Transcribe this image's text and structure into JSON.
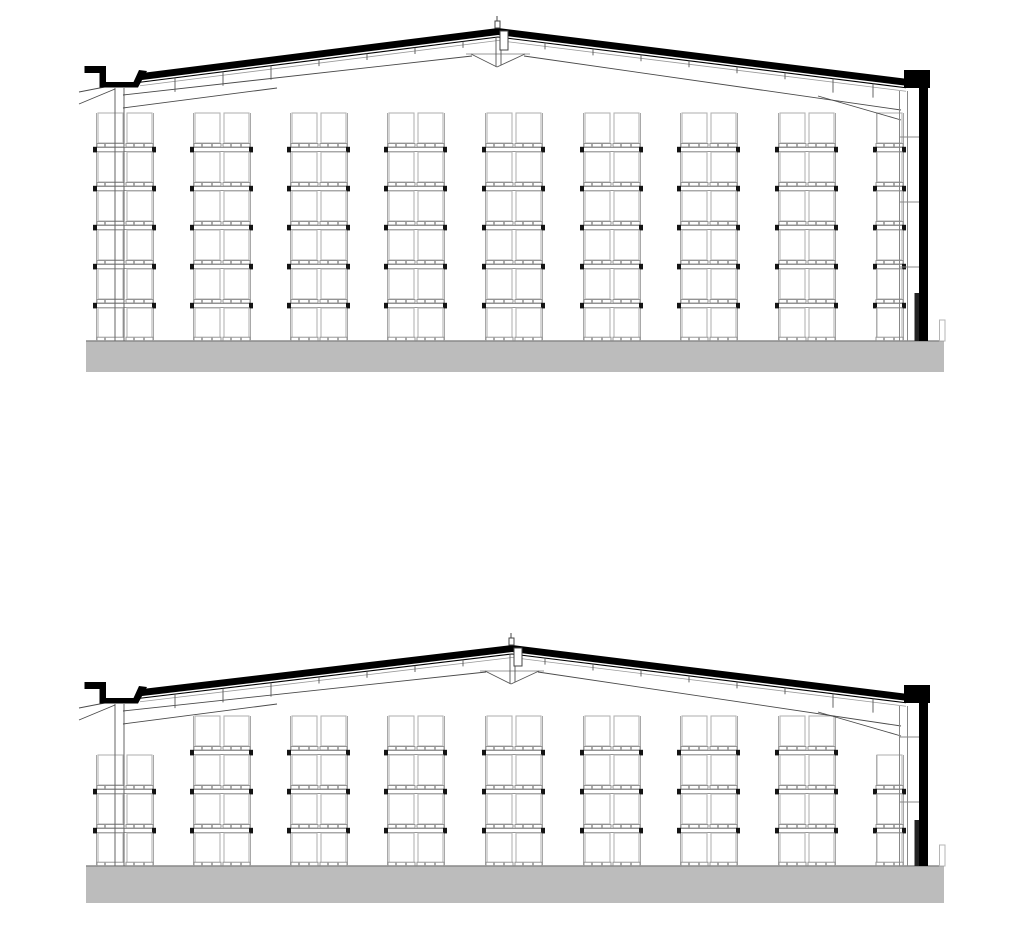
{
  "page": {
    "background": "#ffffff"
  },
  "drawing": {
    "canvas": {
      "width": 1024,
      "height": 950
    },
    "colors": {
      "black": "#000000",
      "line_dark": "#4a4a4a",
      "line_mid": "#8c8c8c",
      "line_light": "#b5b5b5",
      "upright": "#a8a8a8",
      "slab_fill": "#bcbcbc",
      "slab_edge": "#8a8a8a",
      "beam_cap": "#141414",
      "white": "#ffffff"
    },
    "sections": [
      {
        "name": "building-section-upper",
        "ridge": {
          "x": 498,
          "y": 28
        },
        "eave_left": {
          "x": 138,
          "y": 73.5
        },
        "eave_right": {
          "x": 908,
          "y": 79
        },
        "band_thickness": 7,
        "apex": {
          "cap": [
            495,
            21,
            5,
            7
          ],
          "beam": [
            500,
            31,
            8,
            19
          ],
          "bracket_half_width": 27,
          "bracket_top_offset": 26,
          "bracket_tip_offset": 39
        },
        "gutter": {
          "bar": [
            84.5,
            66,
            18,
            7
          ],
          "face": [
            99.5,
            66,
            6.5,
            21
          ],
          "channel": [
            99.5,
            82,
            37,
            5.5
          ],
          "riser": [
            [
              131,
              87.5
            ],
            [
              139,
              70
            ],
            [
              147,
              71
            ],
            [
              138,
              87.5
            ]
          ]
        },
        "parapet": {
          "cap": [
            904,
            70,
            26,
            18
          ],
          "wall": [
            919,
            88,
            9,
            253
          ],
          "strip": [
            914.5,
            293,
            4.5,
            48
          ]
        },
        "left_column": {
          "x": [
            115,
            124
          ],
          "top": 88,
          "bottom": 341
        },
        "right_liner": {
          "x": [
            899.5,
            907.5
          ],
          "top": 91,
          "bottom": 341,
          "girts": [
            137,
            202,
            267
          ],
          "girt_x2": 919
        },
        "cut_lines": [
          [
            79,
            92,
            115,
            85
          ],
          [
            79,
            104,
            115,
            89
          ]
        ],
        "rafter_lines": [
          [
            123,
            95,
            472,
            56
          ],
          [
            524,
            56,
            901,
            110
          ],
          [
            123,
            108,
            277,
            88
          ],
          [
            818,
            96,
            901,
            120
          ]
        ],
        "purlin_ticks": {
          "left": [
            175,
            223,
            271,
            319,
            367,
            415,
            463
          ],
          "right": [
            545,
            593,
            641,
            689,
            737,
            785,
            833,
            873
          ],
          "tall": [
            175,
            223,
            271,
            833,
            873
          ]
        },
        "slab": {
          "rect": [
            86,
            341,
            858,
            31
          ],
          "curb": [
            939.5,
            320,
            5.5,
            21
          ]
        },
        "racks": {
          "box_w": 25,
          "box_h": 30,
          "pitch": 39,
          "double_bays": [
            {
              "x": 96,
              "top": 113,
              "levels": 6
            },
            {
              "x": 193,
              "top": 113,
              "levels": 6
            },
            {
              "x": 290,
              "top": 113,
              "levels": 6
            },
            {
              "x": 387,
              "top": 113,
              "levels": 6
            },
            {
              "x": 485,
              "top": 113,
              "levels": 6
            },
            {
              "x": 583,
              "top": 113,
              "levels": 6
            },
            {
              "x": 680,
              "top": 113,
              "levels": 6
            },
            {
              "x": 778,
              "top": 113,
              "levels": 6
            }
          ],
          "single_bays": [
            {
              "x": 876,
              "top": 113,
              "levels": 6
            }
          ]
        }
      },
      {
        "name": "building-section-lower",
        "ridge": {
          "x": 512,
          "y": 645
        },
        "eave_left": {
          "x": 138,
          "y": 689.5
        },
        "eave_right": {
          "x": 908,
          "y": 694
        },
        "band_thickness": 7,
        "apex": {
          "cap": [
            509,
            638,
            5,
            7
          ],
          "beam": [
            514,
            648,
            8,
            18
          ],
          "bracket_half_width": 27,
          "bracket_top_offset": 26,
          "bracket_tip_offset": 39
        },
        "gutter": {
          "bar": [
            84.5,
            682,
            18,
            7
          ],
          "face": [
            99.5,
            682,
            6.5,
            21
          ],
          "channel": [
            99.5,
            698,
            37,
            5.5
          ],
          "riser": [
            [
              131,
              703.5
            ],
            [
              139,
              686
            ],
            [
              147,
              687
            ],
            [
              138,
              703.5
            ]
          ]
        },
        "parapet": {
          "cap": [
            904,
            685,
            26,
            18
          ],
          "wall": [
            919,
            703,
            9,
            163
          ],
          "strip": [
            914.5,
            820,
            4.5,
            46
          ]
        },
        "left_column": {
          "x": [
            115,
            124
          ],
          "top": 704,
          "bottom": 866
        },
        "right_liner": {
          "x": [
            899.5,
            907.5
          ],
          "top": 706,
          "bottom": 866,
          "girts": [
            737,
            802
          ],
          "girt_x2": 919
        },
        "cut_lines": [
          [
            79,
            708,
            115,
            701
          ],
          [
            79,
            720,
            115,
            705
          ]
        ],
        "rafter_lines": [
          [
            123,
            711,
            486,
            672
          ],
          [
            538,
            672,
            901,
            726
          ],
          [
            123,
            724,
            277,
            704
          ],
          [
            818,
            712,
            901,
            736
          ]
        ],
        "purlin_ticks": {
          "left": [
            175,
            223,
            271,
            319,
            367,
            415,
            463
          ],
          "right": [
            545,
            593,
            641,
            689,
            737,
            785,
            833,
            873
          ],
          "tall": [
            175,
            223,
            271,
            833,
            873
          ]
        },
        "slab": {
          "rect": [
            86,
            866,
            858,
            37
          ],
          "curb": [
            939.5,
            845,
            5.5,
            21
          ]
        },
        "racks": {
          "box_w": 25,
          "box_h": 30,
          "pitch": 39,
          "double_bays": [
            {
              "x": 96,
              "top": 755,
              "levels": 3
            },
            {
              "x": 193,
              "top": 716,
              "levels": 4
            },
            {
              "x": 290,
              "top": 716,
              "levels": 4
            },
            {
              "x": 387,
              "top": 716,
              "levels": 4
            },
            {
              "x": 485,
              "top": 716,
              "levels": 4
            },
            {
              "x": 583,
              "top": 716,
              "levels": 4
            },
            {
              "x": 680,
              "top": 716,
              "levels": 4
            },
            {
              "x": 778,
              "top": 716,
              "levels": 4
            }
          ],
          "single_bays": [
            {
              "x": 876,
              "top": 755,
              "levels": 3
            }
          ]
        }
      }
    ]
  }
}
